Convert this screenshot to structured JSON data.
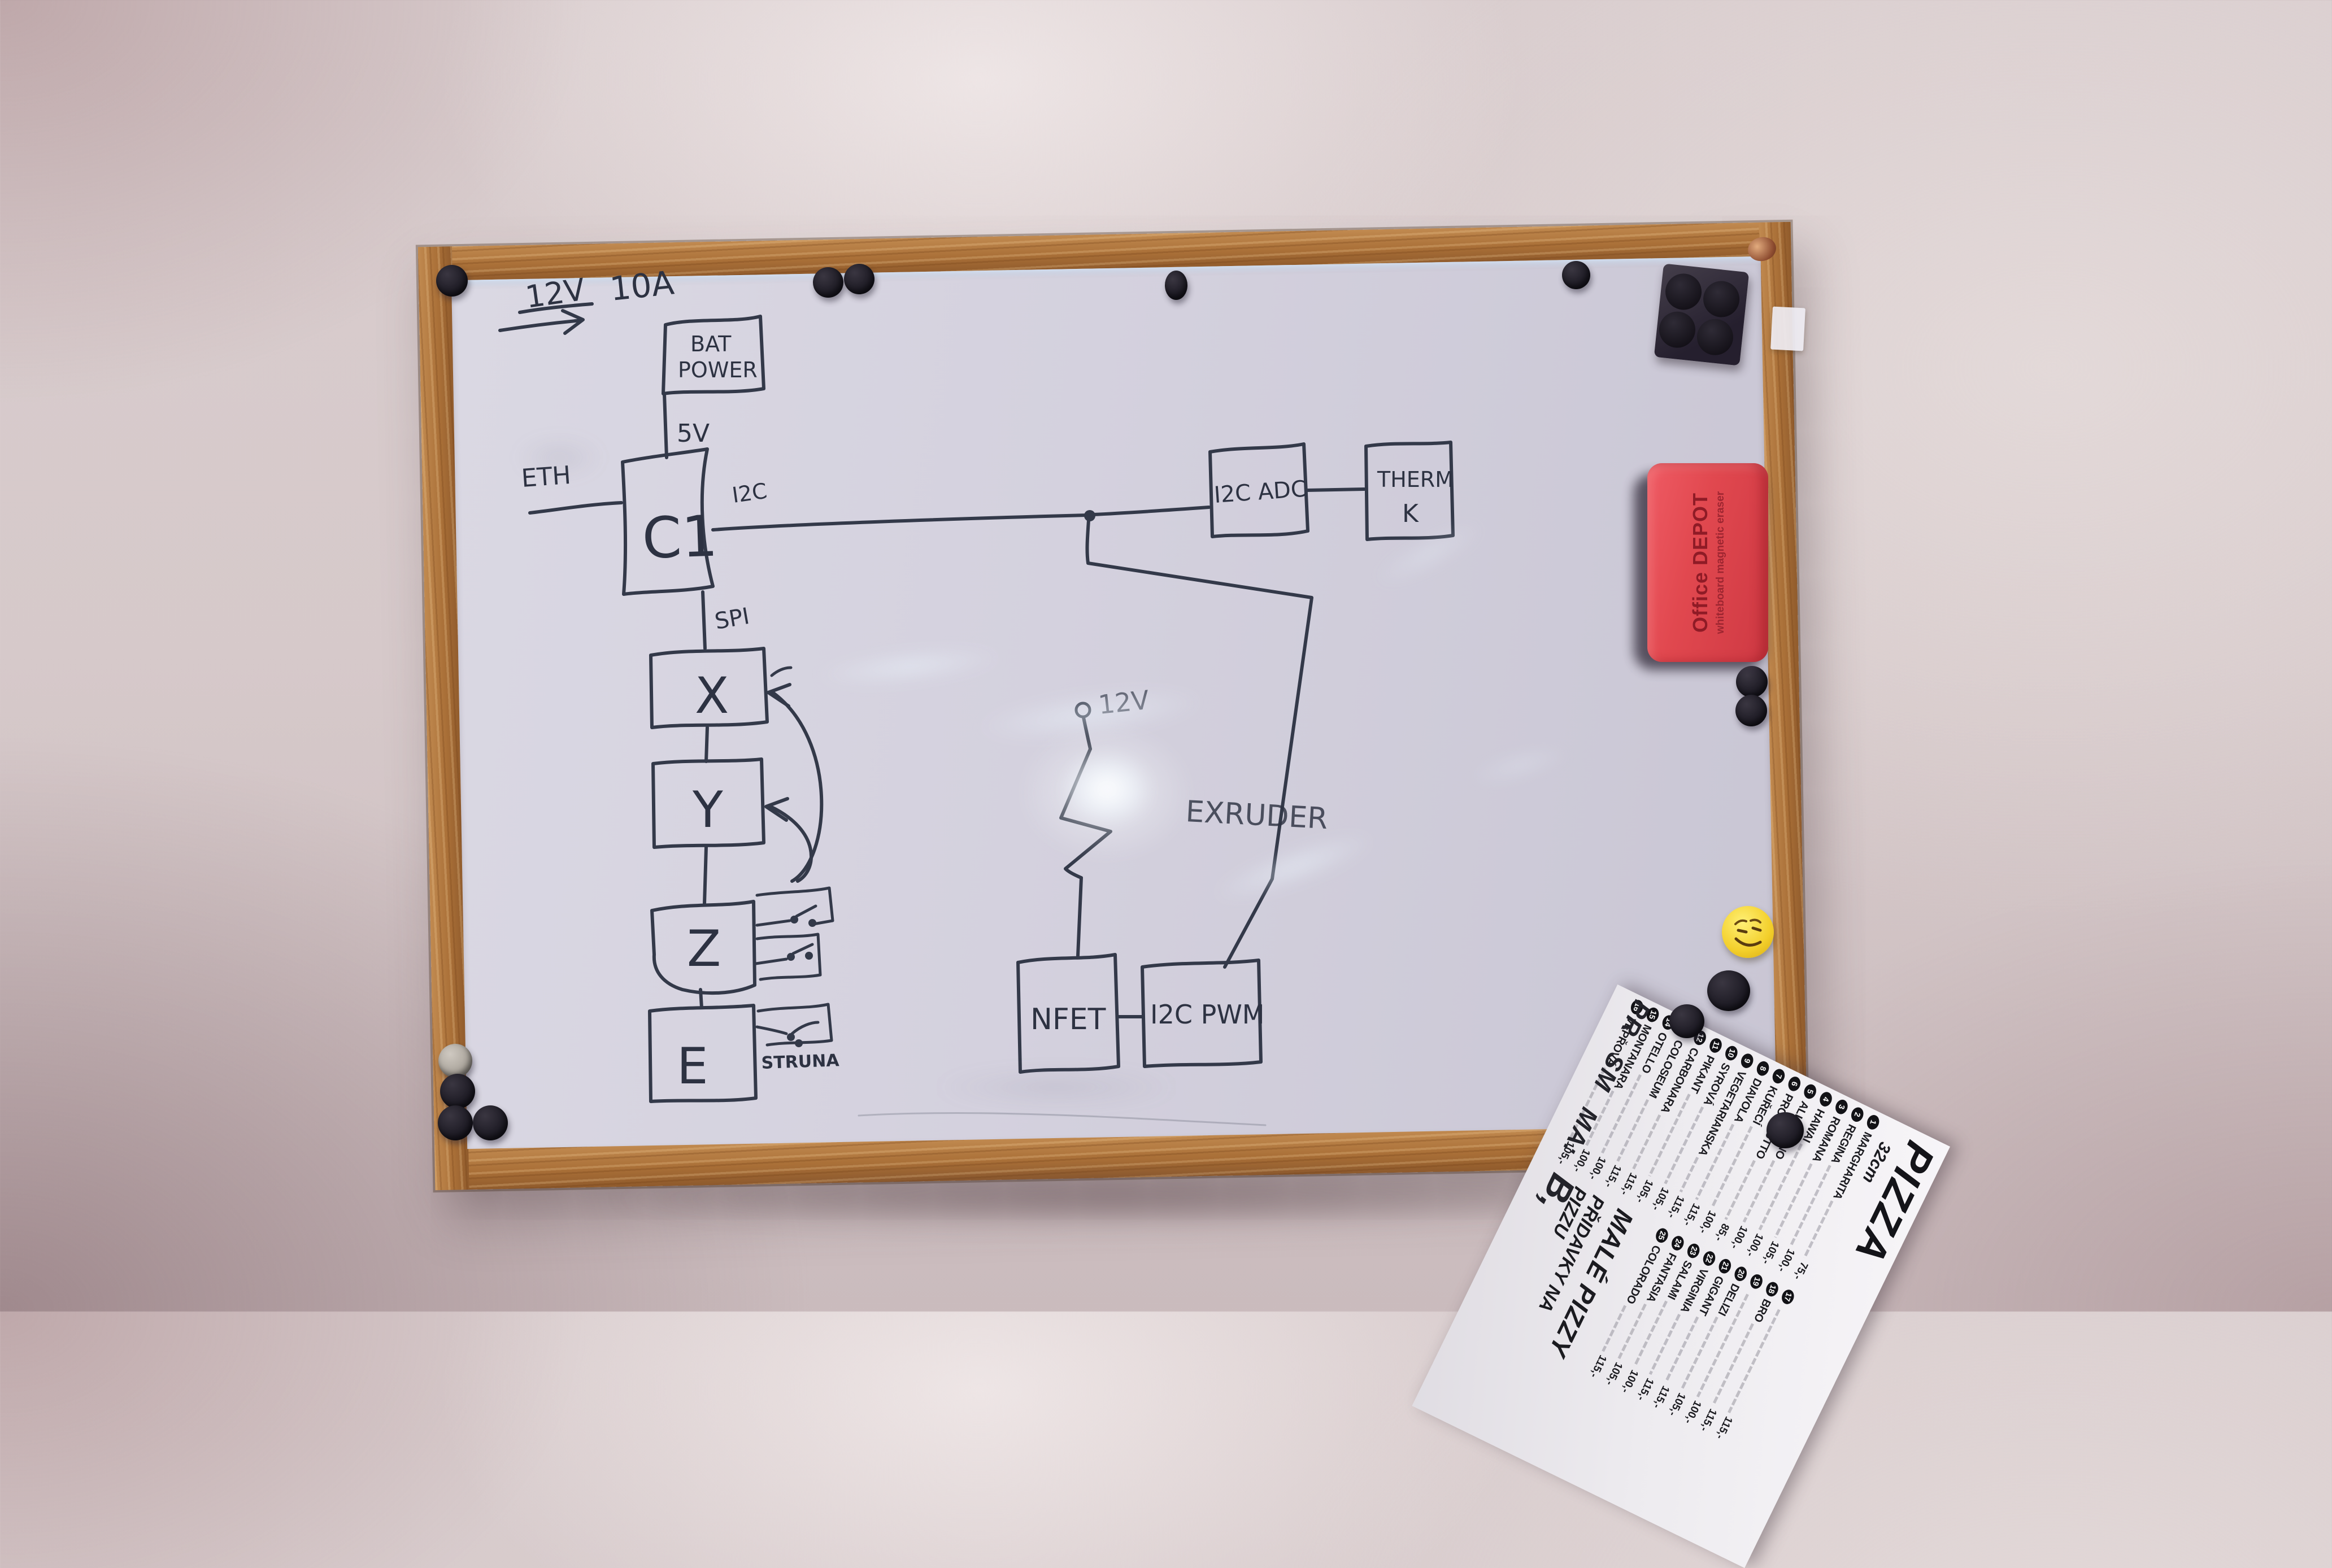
{
  "diagram": {
    "supply_v": "12V",
    "supply_a": "10A",
    "bat_line1": "BAT",
    "bat_line2": "POWER",
    "v5": "5V",
    "eth": "ETH",
    "controller": "C1",
    "i2c": "I2C",
    "spi": "SPI",
    "i2c_adc": "I2C ADC",
    "therm_line1": "THERM",
    "therm_line2": "K",
    "axis_x": "X",
    "axis_y": "Y",
    "axis_z": "Z",
    "axis_e": "E",
    "struna": "STRUNA",
    "v12": "12V",
    "extruder": "EXRUDER",
    "nfet": "NFET",
    "i2c_pwm": "I2C PWM"
  },
  "eraser": {
    "line1": "Office DEPOT",
    "line2": "whiteboard magnetic eraser"
  },
  "leaflet": {
    "title": "PIZZA",
    "size": "32cm",
    "col1": [
      {
        "n": "1",
        "name": "MARGHARITA",
        "price": "75,-"
      },
      {
        "n": "2",
        "name": "REGINA",
        "price": "100,-"
      },
      {
        "n": "3",
        "name": "ROMANA",
        "price": "105,-"
      },
      {
        "n": "4",
        "name": "HAWAI",
        "price": "100,-"
      },
      {
        "n": "5",
        "name": "ALL TONNO",
        "price": "100,-"
      },
      {
        "n": "6",
        "name": "PROSCIUTTO",
        "price": "85,-"
      },
      {
        "n": "7",
        "name": "KUŘECÍ",
        "price": "100,-"
      },
      {
        "n": "8",
        "name": "DIAVOLA",
        "price": "115,-"
      },
      {
        "n": "9",
        "name": "VEGETARIANSKA",
        "price": "115,-"
      },
      {
        "n": "10",
        "name": "SYROVÁ",
        "price": "105,-"
      },
      {
        "n": "11",
        "name": "PIKANT",
        "price": "105,-"
      },
      {
        "n": "12",
        "name": "CARBONARA",
        "price": "115,-"
      },
      {
        "n": "13",
        "name": "COLOSEUM",
        "price": "115,-"
      },
      {
        "n": "14",
        "name": "OTELLO",
        "price": "100,-"
      },
      {
        "n": "15",
        "name": "MONTANARA",
        "price": "100,-"
      },
      {
        "n": "16",
        "name": "VEPŘOVÁ",
        "price": "105,-"
      }
    ],
    "col2": [
      {
        "n": "17",
        "name": "",
        "price": "115,-"
      },
      {
        "n": "18",
        "name": "BRO",
        "price": "115,-"
      },
      {
        "n": "19",
        "name": "",
        "price": "100,-"
      },
      {
        "n": "20",
        "name": "DELIZI",
        "price": "105,-"
      },
      {
        "n": "21",
        "name": "GIGANT",
        "price": "115,-"
      },
      {
        "n": "22",
        "name": "VIRGINIA",
        "price": "115,-"
      },
      {
        "n": "23",
        "name": "SALAMI",
        "price": "100,-"
      },
      {
        "n": "24",
        "name": "FANTASIA",
        "price": "105,-"
      },
      {
        "n": "25",
        "name": "COLORADO",
        "price": "115,-"
      }
    ],
    "section_small": "MALÉ PIZZY",
    "section_extras": "PŘIDAVKY NA PIZZU",
    "fragments": [
      "PR",
      "SM",
      "MA:",
      "B,"
    ]
  },
  "colors": {
    "ink": "#333949",
    "wood_frame": "#aa7038",
    "eraser_red": "#e1484f",
    "smiley_yellow": "#f3cf2b",
    "board_surface": "#d4d1de"
  },
  "objects": {
    "round_magnet_count": 13,
    "gray_magnet_count": 1,
    "tray_magnet_count": 4
  }
}
